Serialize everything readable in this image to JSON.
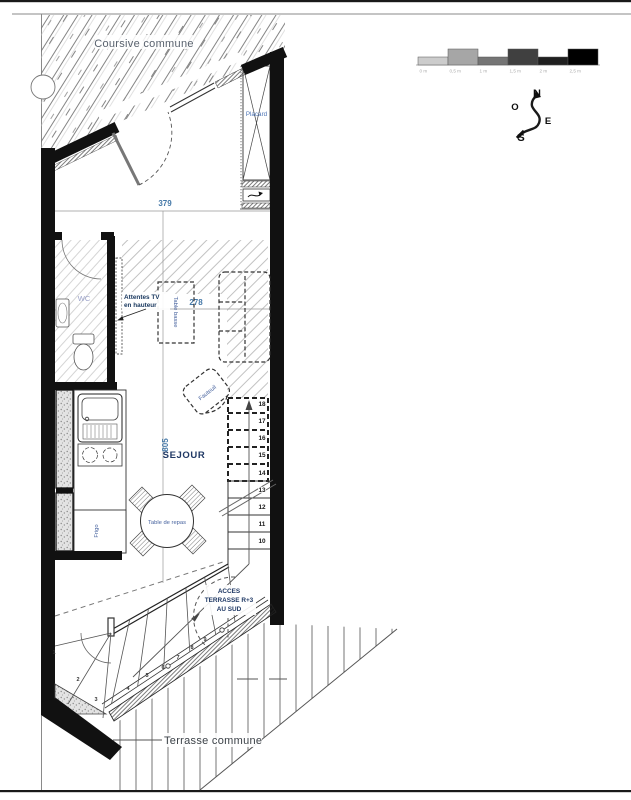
{
  "drawing": {
    "title_areas": {
      "coursive": "Coursive commune",
      "terrasse": "Terrasse commune",
      "sejour": "SEJOUR",
      "wc": "WC",
      "placard": "Placard"
    },
    "furniture": {
      "table_basse": "Table basse",
      "fauteuil": "Fauteuil",
      "table_repas": "Table de repas",
      "frigo": "Frigo"
    },
    "annotations": {
      "attentes_tv_1": "Attentes TV",
      "attentes_tv_2": "en hauteur",
      "acces_1": "ACCES",
      "acces_2": "TERRASSE R+3",
      "acces_3": "AU SUD"
    },
    "dimensions": {
      "entry_width": "379",
      "sejour_width": "278",
      "sejour_length": "805"
    },
    "compass": {
      "north": "N",
      "west": "O",
      "east": "E",
      "south": "S"
    },
    "stairs": {
      "lower_steps": [
        "1",
        "2",
        "3",
        "4",
        "5",
        "6",
        "7",
        "8",
        "9"
      ],
      "upper_steps": [
        "10",
        "11",
        "12",
        "13",
        "14",
        "15",
        "16",
        "17",
        "18"
      ]
    },
    "scale_bar": {
      "segments": [
        {
          "label": "0 m",
          "color": "#cccccc"
        },
        {
          "label": "0,5 m",
          "color": "#a6a6a6"
        },
        {
          "label": "1 m",
          "color": "#757575"
        },
        {
          "label": "1,5 m",
          "color": "#404040"
        },
        {
          "label": "2 m",
          "color": "#1f1f1f"
        },
        {
          "label": "2,5 m",
          "color": "#000000"
        }
      ]
    },
    "colors": {
      "wall": "#111111",
      "label_blue": "#4d74b5",
      "dim_blue": "#4679a8",
      "navy": "#1f3864"
    }
  }
}
